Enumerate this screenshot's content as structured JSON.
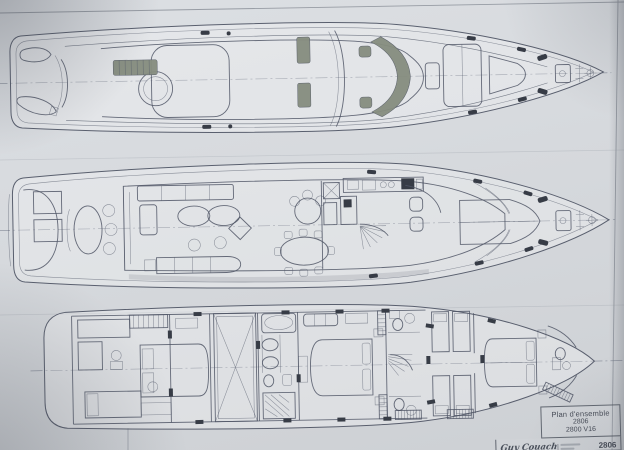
{
  "title_block": {
    "title": "Plan d'ensemble",
    "plan_number": "2806",
    "model_code": "2800 V16",
    "signature": "Guy Couach",
    "reference": "2806"
  },
  "colors": {
    "paper": "#d7dade",
    "ink": "#4f5565",
    "tinted_glass": "#868d7f",
    "dark_fittings": "#373c46"
  }
}
